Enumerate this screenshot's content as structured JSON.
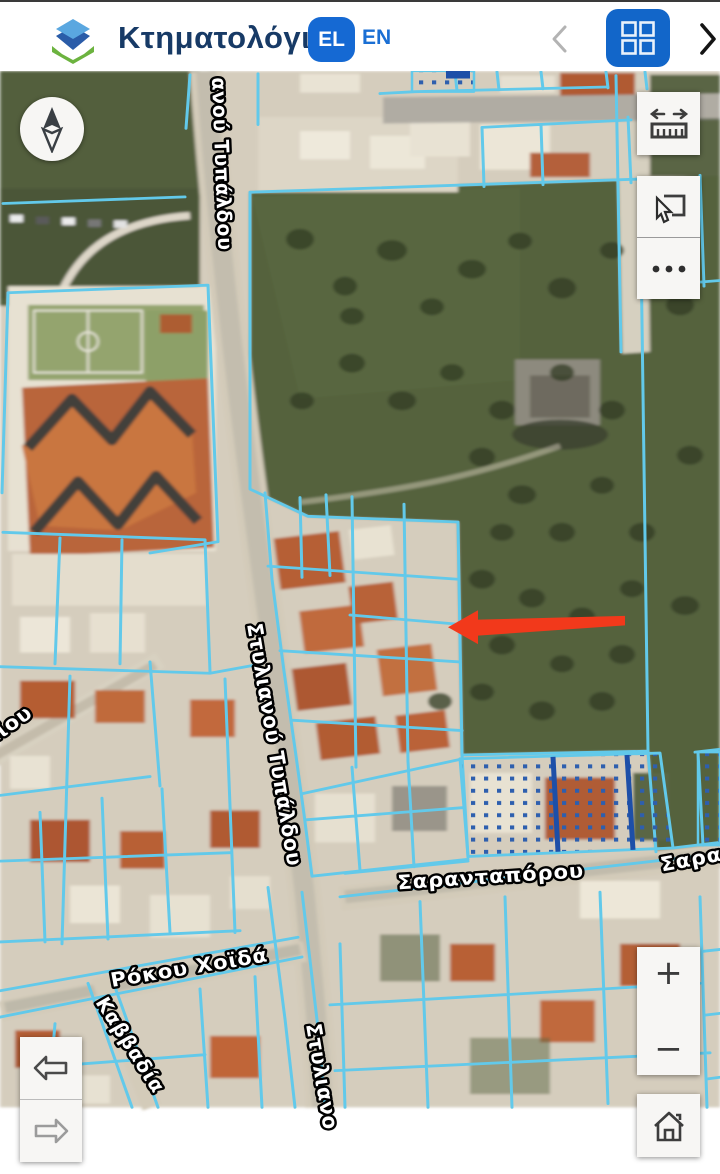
{
  "header": {
    "title": "Κτηματολόγιο",
    "language": {
      "selected": "EL",
      "alternate": "EN"
    }
  },
  "map": {
    "streets": {
      "typaldou_top": "ανού Τυπάλδου",
      "typaldou_mid": "Στυλιανού Τυπάλδου",
      "typaldou_bottom": "Στυλιανο",
      "sarantaporou": "Σαρανταπόρου",
      "sarantaporou_right": "Σαρα",
      "rokou_choida": "Ρόκου Χοϊδά",
      "maiou": "αΐου",
      "kavvadia": "Καββαδία"
    },
    "annotation": {
      "type": "arrow",
      "direction": "left",
      "color": "#f2391b"
    }
  },
  "controls": {
    "zoom_in_label": "+",
    "zoom_out_label": "−"
  },
  "icons": {
    "logo": "cadastre-cube-logo",
    "chevron_left": "collapse-panel",
    "grid": "apps-grid",
    "chevron_right": "expand-panel",
    "compass": "north-needle",
    "measure": "ruler-with-arrows",
    "select": "pointer-select-area",
    "more": "ellipsis",
    "back": "history-back-arrow",
    "forward": "history-forward-arrow",
    "home": "home-extent"
  },
  "colors": {
    "accent_blue": "#1266c9",
    "lang_pill_blue": "#1569d3",
    "title_navy": "#173a66",
    "parcel_line_cyan": "#62c9ea",
    "special_parcel_blue": "#2e5fae",
    "arrow_red": "#f2391b"
  }
}
